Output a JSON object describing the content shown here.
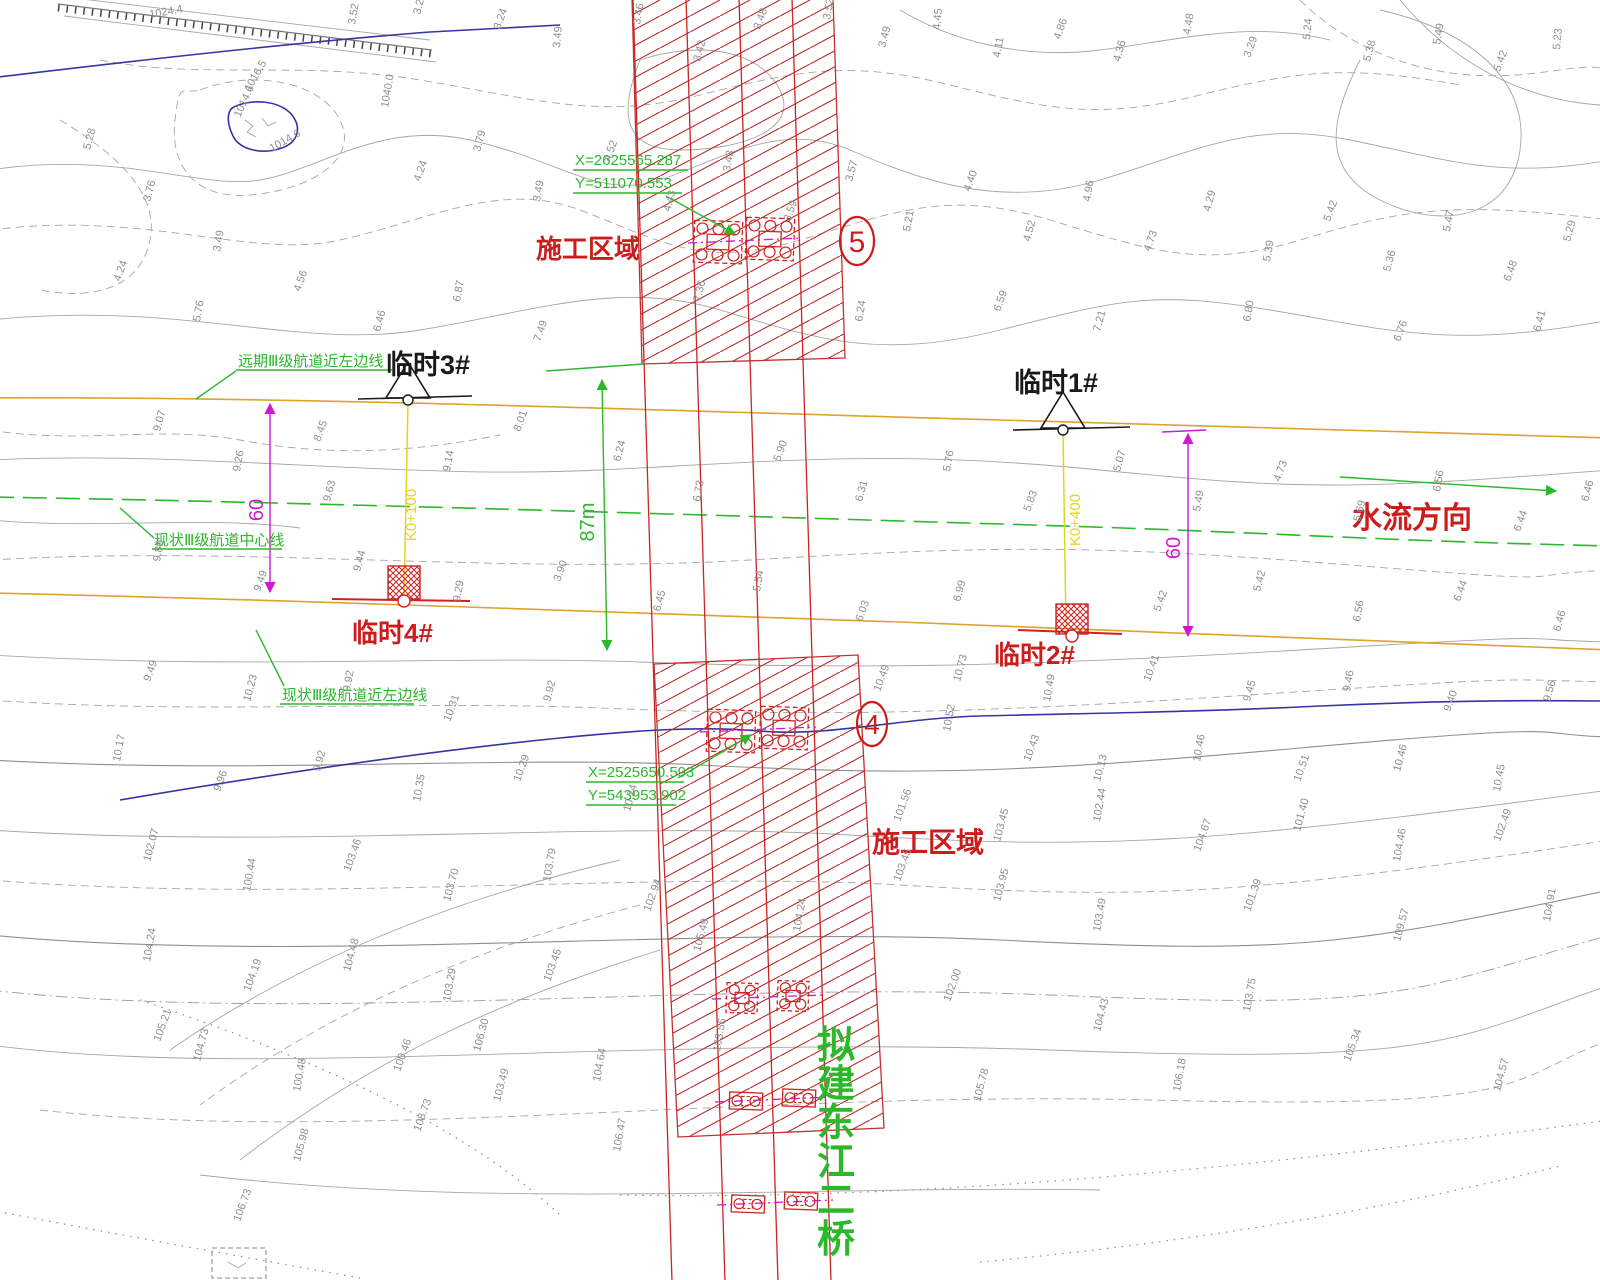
{
  "labels": {
    "zone5_area": "施工区域",
    "zone4_area": "施工区域",
    "zone5_num": "5",
    "zone4_num": "4",
    "temp1": "临时1#",
    "temp2": "临时2#",
    "temp3": "临时3#",
    "temp4": "临时4#",
    "flow_direction": "水流方向",
    "bridge_name": "拟建东江二桥",
    "dim_left": "60",
    "dim_right": "60",
    "dim_span": "87m",
    "station_left": "K0+100",
    "station_right": "K0+400",
    "coord_top_x": "X=2625565.287",
    "coord_top_y": "Y=511070.553",
    "coord_bottom_x": "X=2525650.593",
    "coord_bottom_y": "Y=543953.902",
    "channel_far_left_edge": "远期Ⅲ级航道近左边线",
    "channel_centerline": "现状Ⅲ级航道中心线",
    "channel_near_left_edge": "现状Ⅲ级航道近左边线"
  },
  "colors": {
    "hatch_red": "#c43030",
    "line_red": "#cc2424",
    "channel_yellow": "#dda32c",
    "nav_green": "#2bb82b",
    "dim_magenta": "#d316d3",
    "river_blue": "#3434a4",
    "contour_gray": "#a6a6a6"
  },
  "spot_elevations": [
    [
      150,
      18,
      -10,
      "1024.4"
    ],
    [
      250,
      92,
      -60,
      "1016.5"
    ],
    [
      240,
      118,
      -65,
      "1014.6"
    ],
    [
      272,
      152,
      -30,
      "1014.6"
    ],
    [
      388,
      108,
      -80,
      "1040.0"
    ],
    [
      355,
      25,
      -80,
      "3.52"
    ],
    [
      420,
      15,
      -75,
      "3.28"
    ],
    [
      500,
      30,
      -70,
      "3.24"
    ],
    [
      560,
      48,
      -85,
      "3.49"
    ],
    [
      640,
      25,
      -80,
      "3.46"
    ],
    [
      700,
      62,
      -75,
      "3.42"
    ],
    [
      760,
      30,
      -70,
      "3.48"
    ],
    [
      830,
      20,
      -80,
      "3.52"
    ],
    [
      885,
      48,
      -75,
      "3.49"
    ],
    [
      940,
      30,
      -85,
      "4.45"
    ],
    [
      1000,
      58,
      -80,
      "4.11"
    ],
    [
      1060,
      40,
      -70,
      "4.86"
    ],
    [
      1120,
      62,
      -75,
      "4.36"
    ],
    [
      1190,
      35,
      -80,
      "4.48"
    ],
    [
      1250,
      58,
      -70,
      "3.29"
    ],
    [
      1310,
      40,
      -85,
      "5.24"
    ],
    [
      1370,
      62,
      -75,
      "5.38"
    ],
    [
      1440,
      45,
      -80,
      "5.49"
    ],
    [
      1500,
      72,
      -70,
      "5.42"
    ],
    [
      1560,
      50,
      -85,
      "5.23"
    ],
    [
      90,
      150,
      -75,
      "5.28"
    ],
    [
      120,
      282,
      -70,
      "4.24"
    ],
    [
      150,
      202,
      -75,
      "3.76"
    ],
    [
      220,
      252,
      -80,
      "3.49"
    ],
    [
      300,
      292,
      -70,
      "4.56"
    ],
    [
      380,
      332,
      -75,
      "6.46"
    ],
    [
      200,
      322,
      -80,
      "5.76"
    ],
    [
      420,
      182,
      -70,
      "4.24"
    ],
    [
      480,
      152,
      -75,
      "3.79"
    ],
    [
      540,
      202,
      -80,
      "3.49"
    ],
    [
      610,
      162,
      -70,
      "4.52"
    ],
    [
      670,
      212,
      -75,
      "4.43"
    ],
    [
      730,
      172,
      -80,
      "3.43"
    ],
    [
      790,
      222,
      -70,
      "3.59"
    ],
    [
      852,
      182,
      -75,
      "3.57"
    ],
    [
      910,
      232,
      -80,
      "5.21"
    ],
    [
      970,
      192,
      -70,
      "4.40"
    ],
    [
      1030,
      242,
      -75,
      "4.52"
    ],
    [
      1090,
      202,
      -80,
      "4.96"
    ],
    [
      1150,
      252,
      -70,
      "4.73"
    ],
    [
      1210,
      212,
      -75,
      "4.29"
    ],
    [
      1270,
      262,
      -80,
      "5.39"
    ],
    [
      1330,
      222,
      -70,
      "5.42"
    ],
    [
      1390,
      272,
      -75,
      "5.36"
    ],
    [
      1450,
      232,
      -80,
      "5.47"
    ],
    [
      1510,
      282,
      -70,
      "6.48"
    ],
    [
      1570,
      242,
      -75,
      "5.29"
    ],
    [
      460,
      302,
      -80,
      "6.87"
    ],
    [
      540,
      342,
      -70,
      "7.49"
    ],
    [
      700,
      302,
      -75,
      "7.36"
    ],
    [
      862,
      322,
      -80,
      "6.24"
    ],
    [
      1000,
      312,
      -70,
      "6.59"
    ],
    [
      1100,
      332,
      -75,
      "7.21"
    ],
    [
      1250,
      322,
      -80,
      "6.80"
    ],
    [
      1400,
      342,
      -70,
      "6.76"
    ],
    [
      1540,
      332,
      -75,
      "6.41"
    ],
    [
      160,
      432,
      -75,
      "9.07"
    ],
    [
      240,
      472,
      -80,
      "9.26"
    ],
    [
      320,
      442,
      -70,
      "8.45"
    ],
    [
      330,
      502,
      -75,
      "9.63"
    ],
    [
      450,
      472,
      -80,
      "9.14"
    ],
    [
      520,
      432,
      -70,
      "8.01"
    ],
    [
      620,
      462,
      -75,
      "6.24"
    ],
    [
      700,
      502,
      -80,
      "6.73"
    ],
    [
      780,
      462,
      -70,
      "5.90"
    ],
    [
      862,
      502,
      -75,
      "6.31"
    ],
    [
      950,
      472,
      -80,
      "5.76"
    ],
    [
      1030,
      512,
      -70,
      "5.83"
    ],
    [
      1120,
      472,
      -75,
      "5.07"
    ],
    [
      1200,
      512,
      -80,
      "5.49"
    ],
    [
      1280,
      482,
      -70,
      "4.73"
    ],
    [
      1360,
      522,
      -75,
      "5.69"
    ],
    [
      1440,
      492,
      -80,
      "6.56"
    ],
    [
      1520,
      532,
      -70,
      "6.44"
    ],
    [
      1588,
      502,
      -75,
      "6.46"
    ],
    [
      160,
      562,
      -80,
      "9.89"
    ],
    [
      260,
      592,
      -70,
      "9.49"
    ],
    [
      360,
      572,
      -75,
      "9.44"
    ],
    [
      460,
      602,
      -80,
      "9.29"
    ],
    [
      560,
      582,
      -70,
      "3.90"
    ],
    [
      660,
      612,
      -75,
      "6.45"
    ],
    [
      760,
      592,
      -80,
      "5.54"
    ],
    [
      862,
      622,
      -70,
      "6.03"
    ],
    [
      960,
      602,
      -75,
      "6.99"
    ],
    [
      1160,
      612,
      -70,
      "5.42"
    ],
    [
      1260,
      592,
      -75,
      "5.42"
    ],
    [
      1360,
      622,
      -80,
      "6.56"
    ],
    [
      1460,
      602,
      -70,
      "6.44"
    ],
    [
      1560,
      632,
      -75,
      "6.46"
    ],
    [
      150,
      682,
      -70,
      "9.49"
    ],
    [
      250,
      702,
      -75,
      "10.23"
    ],
    [
      350,
      692,
      -80,
      "9.92"
    ],
    [
      450,
      722,
      -70,
      "10.31"
    ],
    [
      550,
      702,
      -75,
      "9.92"
    ],
    [
      120,
      762,
      -80,
      "10.17"
    ],
    [
      220,
      792,
      -70,
      "9.96"
    ],
    [
      320,
      772,
      -75,
      "9.92"
    ],
    [
      420,
      802,
      -80,
      "10.35"
    ],
    [
      520,
      782,
      -70,
      "10.29"
    ],
    [
      630,
      812,
      -75,
      "10.24"
    ],
    [
      880,
      692,
      -70,
      "10.49"
    ],
    [
      960,
      682,
      -75,
      "10.73"
    ],
    [
      1050,
      702,
      -80,
      "10.49"
    ],
    [
      1150,
      682,
      -70,
      "10.41"
    ],
    [
      1250,
      702,
      -75,
      "9.45"
    ],
    [
      1350,
      692,
      -80,
      "9.46"
    ],
    [
      1450,
      712,
      -70,
      "9.40"
    ],
    [
      1550,
      702,
      -75,
      "9.56"
    ],
    [
      950,
      732,
      -80,
      "10.52"
    ],
    [
      1030,
      762,
      -70,
      "10.43"
    ],
    [
      1100,
      782,
      -75,
      "10.13"
    ],
    [
      1200,
      762,
      -80,
      "10.46"
    ],
    [
      1300,
      782,
      -70,
      "10.51"
    ],
    [
      1400,
      772,
      -75,
      "10.46"
    ],
    [
      1500,
      792,
      -80,
      "10.45"
    ],
    [
      900,
      822,
      -70,
      "101.56"
    ],
    [
      1000,
      842,
      -75,
      "103.45"
    ],
    [
      1100,
      822,
      -80,
      "102.44"
    ],
    [
      1200,
      852,
      -70,
      "104.67"
    ],
    [
      1300,
      832,
      -75,
      "101.40"
    ],
    [
      1400,
      862,
      -80,
      "104.46"
    ],
    [
      1500,
      842,
      -70,
      "102.49"
    ],
    [
      150,
      862,
      -75,
      "102.07"
    ],
    [
      250,
      892,
      -80,
      "100.44"
    ],
    [
      350,
      872,
      -70,
      "103.46"
    ],
    [
      450,
      902,
      -75,
      "103.70"
    ],
    [
      550,
      882,
      -80,
      "103.79"
    ],
    [
      650,
      912,
      -70,
      "102.94"
    ],
    [
      150,
      962,
      -80,
      "104.24"
    ],
    [
      250,
      992,
      -70,
      "104.19"
    ],
    [
      350,
      972,
      -75,
      "104.48"
    ],
    [
      450,
      1002,
      -80,
      "103.29"
    ],
    [
      550,
      982,
      -70,
      "103.45"
    ],
    [
      200,
      1062,
      -75,
      "104.73"
    ],
    [
      300,
      1092,
      -80,
      "100.48"
    ],
    [
      400,
      1072,
      -70,
      "100.46"
    ],
    [
      500,
      1102,
      -75,
      "103.49"
    ],
    [
      600,
      1082,
      -80,
      "104.64"
    ],
    [
      900,
      882,
      -70,
      "103.45"
    ],
    [
      1000,
      902,
      -75,
      "103.95"
    ],
    [
      1100,
      932,
      -80,
      "103.49"
    ],
    [
      1250,
      912,
      -70,
      "101.39"
    ],
    [
      1400,
      942,
      -75,
      "109.57"
    ],
    [
      1550,
      922,
      -80,
      "104.91"
    ],
    [
      950,
      1002,
      -70,
      "102.00"
    ],
    [
      1100,
      1032,
      -75,
      "104.43"
    ],
    [
      1250,
      1012,
      -80,
      "103.75"
    ],
    [
      700,
      952,
      -75,
      "105.49"
    ],
    [
      800,
      932,
      -80,
      "104.24"
    ],
    [
      1350,
      1062,
      -70,
      "105.34"
    ],
    [
      1500,
      1092,
      -75,
      "104.57"
    ],
    [
      420,
      1132,
      -70,
      "108.73"
    ],
    [
      300,
      1162,
      -75,
      "105.98"
    ],
    [
      620,
      1152,
      -80,
      "106.47"
    ],
    [
      160,
      1042,
      -70,
      "105.21"
    ],
    [
      480,
      1052,
      -75,
      "106.30"
    ],
    [
      720,
      1052,
      -80,
      "103.56"
    ],
    [
      240,
      1222,
      -70,
      "106.73"
    ],
    [
      980,
      1102,
      -75,
      "105.78"
    ],
    [
      1180,
      1092,
      -80,
      "106.18"
    ]
  ]
}
